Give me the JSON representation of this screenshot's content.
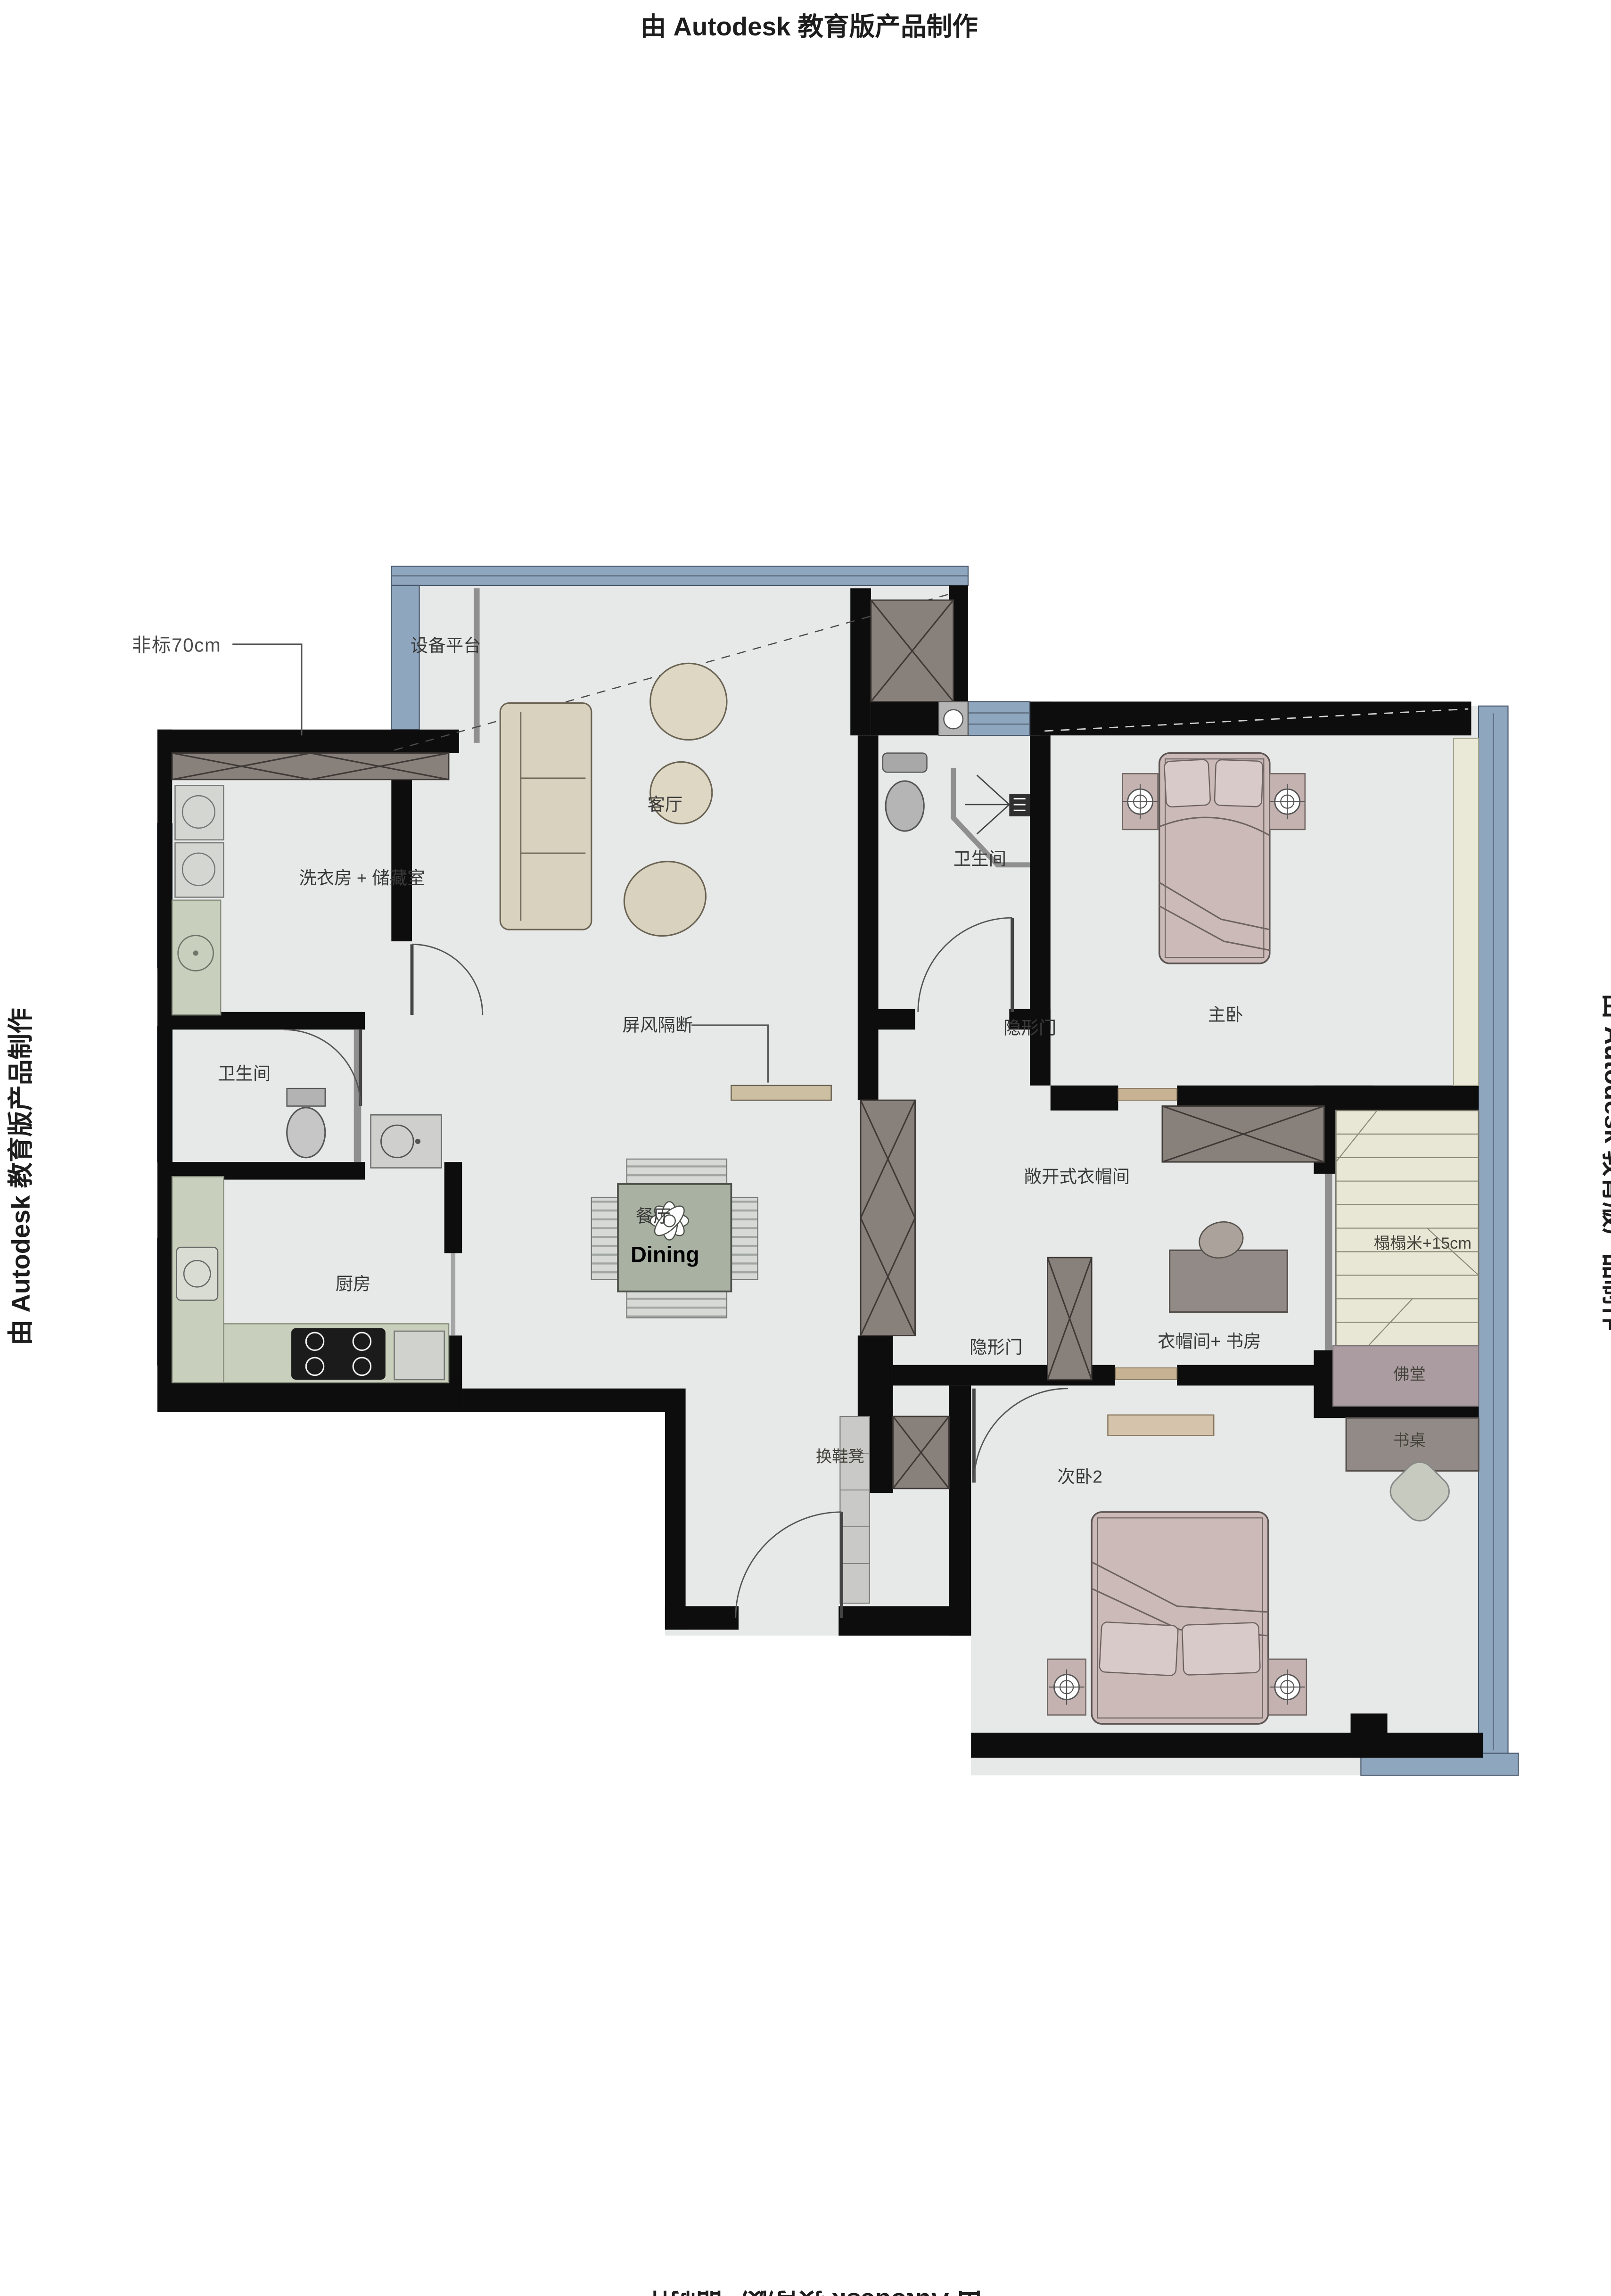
{
  "watermark": {
    "text": "由 Autodesk 教育版产品制作"
  },
  "floorplan": {
    "labels": {
      "equipment_platform": "设备平台",
      "living_room": "客厅",
      "laundry_storage": "洗衣房 + 储藏室",
      "bathroom_top": "卫生间",
      "bathroom_left": "卫生间",
      "hidden_door_top": "隐形门",
      "hidden_door_bottom": "隐形门",
      "master_bedroom": "主卧",
      "screen_partition": "屏风隔断",
      "open_cloakroom": "敞开式衣帽间",
      "tatami": "榻榻米+15cm",
      "dining_cn": "餐厅",
      "dining_en": "Dining",
      "kitchen": "厨房",
      "cloakroom_study": "衣帽间+ 书房",
      "buddha_hall": "佛堂",
      "desk": "书桌",
      "bedroom2": "次卧2",
      "shoe_bench": "换鞋凳",
      "annotation_70cm": "非标70cm"
    },
    "colors": {
      "wall": "#0d0d0d",
      "window_band": "#8fa6bf",
      "floor": "#e7e9e8",
      "cabinet": "#87807b",
      "bed": "#cbbab8",
      "pillow": "#d8cac8",
      "tatami": "#e8e7d5",
      "buddha_room": "#aa9ca1",
      "counter": "#c9cfbd",
      "sofa": "#d9d2bf",
      "dining_table": "#a9b1a3",
      "curtain": "#eae8d6",
      "desk": "#918a86",
      "threshold": "#c8b294"
    }
  }
}
